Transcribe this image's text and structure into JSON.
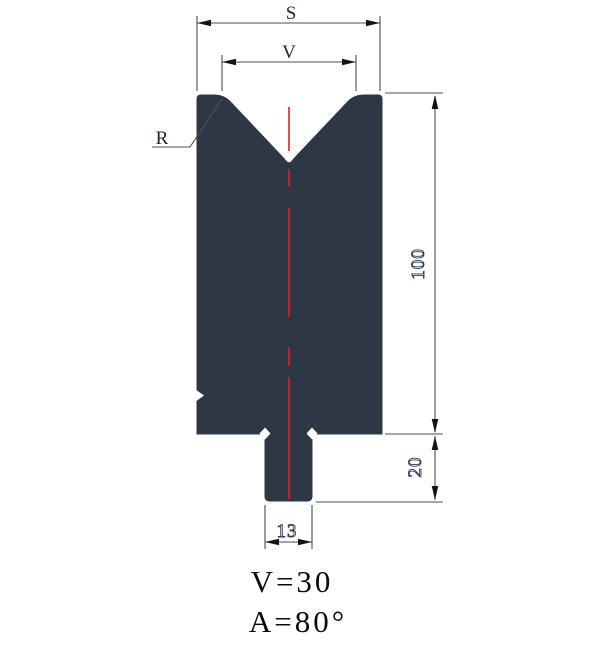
{
  "drawing": {
    "type": "press-brake V-die cross-section",
    "colors": {
      "body": "#2e3744",
      "centerline": "#e01f26",
      "dimension_line": "#4d4d4d",
      "arrow": "#141414",
      "label_text": "#1b2433",
      "digit_fill": "#ffffff",
      "digit_outline": "#2e3a55",
      "note_text": "#0a0a0a",
      "background": "#ffffff"
    },
    "labels": {
      "overall_width": "S",
      "vee_opening": "V",
      "shoulder_radius": "R",
      "body_height": "100",
      "shank_height": "20",
      "shank_width": "13"
    },
    "notes": {
      "line1": "V=30",
      "line2": "A=80°"
    }
  }
}
